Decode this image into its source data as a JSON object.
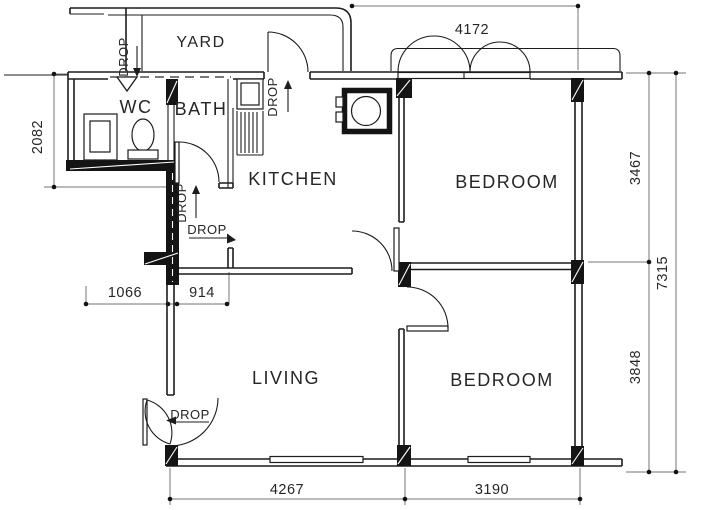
{
  "document_kind": "apartment floor plan drawing",
  "colors": {
    "background": "#ffffff",
    "wall_line": "#1c1c1c",
    "column_fill": "#141414",
    "dimension_line": "#767676",
    "text": "#262626"
  },
  "rooms": {
    "yard": "YARD",
    "wc": "WC",
    "bath": "BATH",
    "kitchen": "KITCHEN",
    "bedroom_top": "BEDROOM",
    "living": "LIVING",
    "bedroom_bottom": "BEDROOM"
  },
  "dimensions_mm": {
    "top_width": "4172",
    "left_height": "2082",
    "right_upper": "3467",
    "right_total": "7315",
    "right_lower": "3848",
    "wc_width": "1066",
    "passage_width": "914",
    "bottom_left": "4267",
    "bottom_right": "3190"
  },
  "drops": {
    "wc": "DROP",
    "service_yard": "DROP",
    "bath": "DROP",
    "kitchen_passage": "DROP",
    "entrance": "DROP"
  },
  "symbols": [
    "toilet-icon",
    "wash-basin-icon",
    "sink-drying-rack-icon",
    "refuse-chute-icon",
    "door-swing-arc-icon",
    "casement-window-arc-icon",
    "floor-trap-triangle-icon"
  ]
}
